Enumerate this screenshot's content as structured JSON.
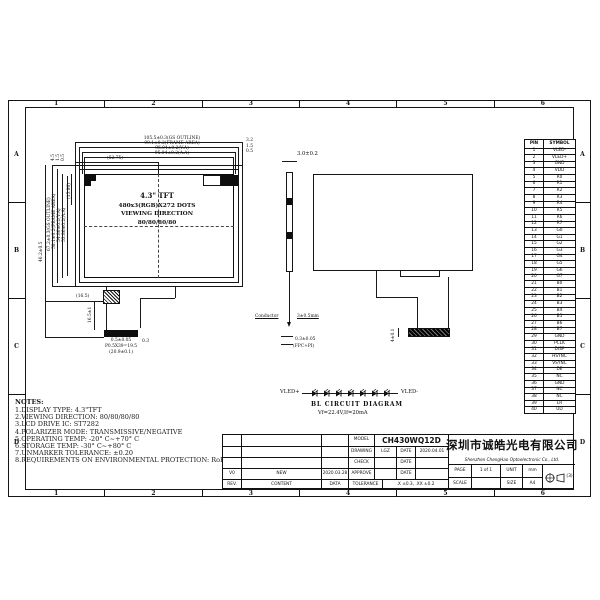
{
  "sheet": {
    "zone_numbers": [
      "1",
      "2",
      "3",
      "4",
      "5",
      "6"
    ],
    "zone_letters": [
      "A",
      "B",
      "C",
      "D"
    ]
  },
  "front_view": {
    "display_lines": [
      "4.3\" TFT",
      "480x3(RGB)X272 DOTS",
      "VIEWING DIRECTION",
      "80/80/80/80"
    ],
    "dims_top": [
      "105.5±0.3(GS OUTLINE)",
      "99.1±0.2(FRAME AREA)",
      "96.04±0.2(V.A)",
      "95.04±0.2(A.A)"
    ],
    "dim_center": "(52.75)",
    "dims_top_right": [
      "3.2",
      "1.5",
      "0.5"
    ],
    "dims_top_left": [
      "4.5",
      "1.5",
      "0.5"
    ],
    "dims_left": [
      "67.2±0.3(GS OUTLINE)",
      "58.1±0.2(FRAME AREA)",
      "54.86±0.2(V.A)",
      "53.86±0.2(A.A)"
    ],
    "dim_inner_left": "(15.80)",
    "dim_total_height": "46.2±0.5",
    "dim_fpc_offset": "(16.5)",
    "dim_fpc_length": "16.5±1",
    "connector_dims": [
      "0.5±0.05",
      "P0.5X39=19.5",
      "(20.9±0.1)"
    ],
    "connector_side": "0.3"
  },
  "side_view": {
    "thickness": "3.0±0.2",
    "conductor_label": "Conductor",
    "fold_label": "3±0.5mm",
    "fpc_thickness": "0.3±0.05",
    "fpc_note": "(FPC+PI)"
  },
  "rear_view": {
    "connector_height": "4±0.1"
  },
  "bl_circuit": {
    "left_label": "VLED+",
    "right_label": "VLED-",
    "title": "BL  CIRCUIT  DIAGRAM",
    "subtitle": "Vf=22.4V,If=20mA",
    "led_count": 7
  },
  "notes": {
    "title": "NOTES:",
    "items": [
      "1.DISPLAY TYPE:  4.3\"TFT",
      "2.VIEWING DIRECTION: 80/80/80/80",
      "3.LCD DRIVE IC: ST7282",
      "4.POLARIZER MODE: TRANSMISSIVE/NEGATIVE",
      "5.OPERATING TEMP: -20° C~+70° C",
      "6.STORAGE TEMP: -30° C~+80° C",
      "7.UNMARKER TOLERANCE: ±0.20",
      "8.REQUIREMENTS ON ENVIRONMENTAL PROTECTION: RoHS"
    ]
  },
  "pin_table": {
    "headers": [
      "PIN",
      "SYMBOL"
    ],
    "rows": [
      [
        "1",
        "VLED-"
      ],
      [
        "2",
        "VLED+"
      ],
      [
        "3",
        "GND"
      ],
      [
        "4",
        "VDD"
      ],
      [
        "5",
        "R0"
      ],
      [
        "6",
        "R1"
      ],
      [
        "7",
        "R2"
      ],
      [
        "8",
        "R3"
      ],
      [
        "9",
        "R4"
      ],
      [
        "10",
        "R5"
      ],
      [
        "11",
        "R6"
      ],
      [
        "12",
        "R7"
      ],
      [
        "13",
        "G0"
      ],
      [
        "14",
        "G1"
      ],
      [
        "15",
        "G2"
      ],
      [
        "16",
        "G3"
      ],
      [
        "17",
        "G4"
      ],
      [
        "18",
        "G5"
      ],
      [
        "19",
        "G6"
      ],
      [
        "20",
        "G7"
      ],
      [
        "21",
        "B0"
      ],
      [
        "22",
        "B1"
      ],
      [
        "23",
        "B2"
      ],
      [
        "24",
        "B3"
      ],
      [
        "25",
        "B4"
      ],
      [
        "26",
        "B5"
      ],
      [
        "27",
        "B6"
      ],
      [
        "28",
        "B7"
      ],
      [
        "29",
        "GND"
      ],
      [
        "30",
        "PCLK"
      ],
      [
        "31",
        "DISP"
      ],
      [
        "32",
        "HSYNC"
      ],
      [
        "33",
        "VSYNC"
      ],
      [
        "34",
        "DE"
      ],
      [
        "35",
        "NC"
      ],
      [
        "36",
        "GND"
      ],
      [
        "37",
        "NC"
      ],
      [
        "38",
        "NC"
      ],
      [
        "39",
        "LR"
      ],
      [
        "40",
        "UD"
      ]
    ]
  },
  "title_block": {
    "rev_row": {
      "rev": "V0",
      "content": "NEW",
      "date": "2020.03.28"
    },
    "rev_header": {
      "rev": "REV.",
      "content": "CONTENT",
      "date": "DATA"
    },
    "model_label": "MODEL",
    "model": "CH430WQ12D",
    "drawing_label": "DRAWING",
    "drawing": "LGZ",
    "date_label": "DATE",
    "drawing_date": "2020.04.01",
    "check_label": "CHECK",
    "approve_label": "APPROVE",
    "tolerance_label": "TOLERANCE",
    "tolerance": ".X ±0.3, .XX ±0.2",
    "scale_label": "SCALE",
    "company_cn": "深圳市诚皓光电有限公司",
    "company_en": "Shenzhen ChengHao Optoelectronic Co., Ltd.",
    "page_label": "PAGE",
    "page": "1 of 1",
    "unit_label": "UNIT",
    "unit": "mm",
    "size_label": "SIZE",
    "size": "A4",
    "projection": "(3)"
  }
}
